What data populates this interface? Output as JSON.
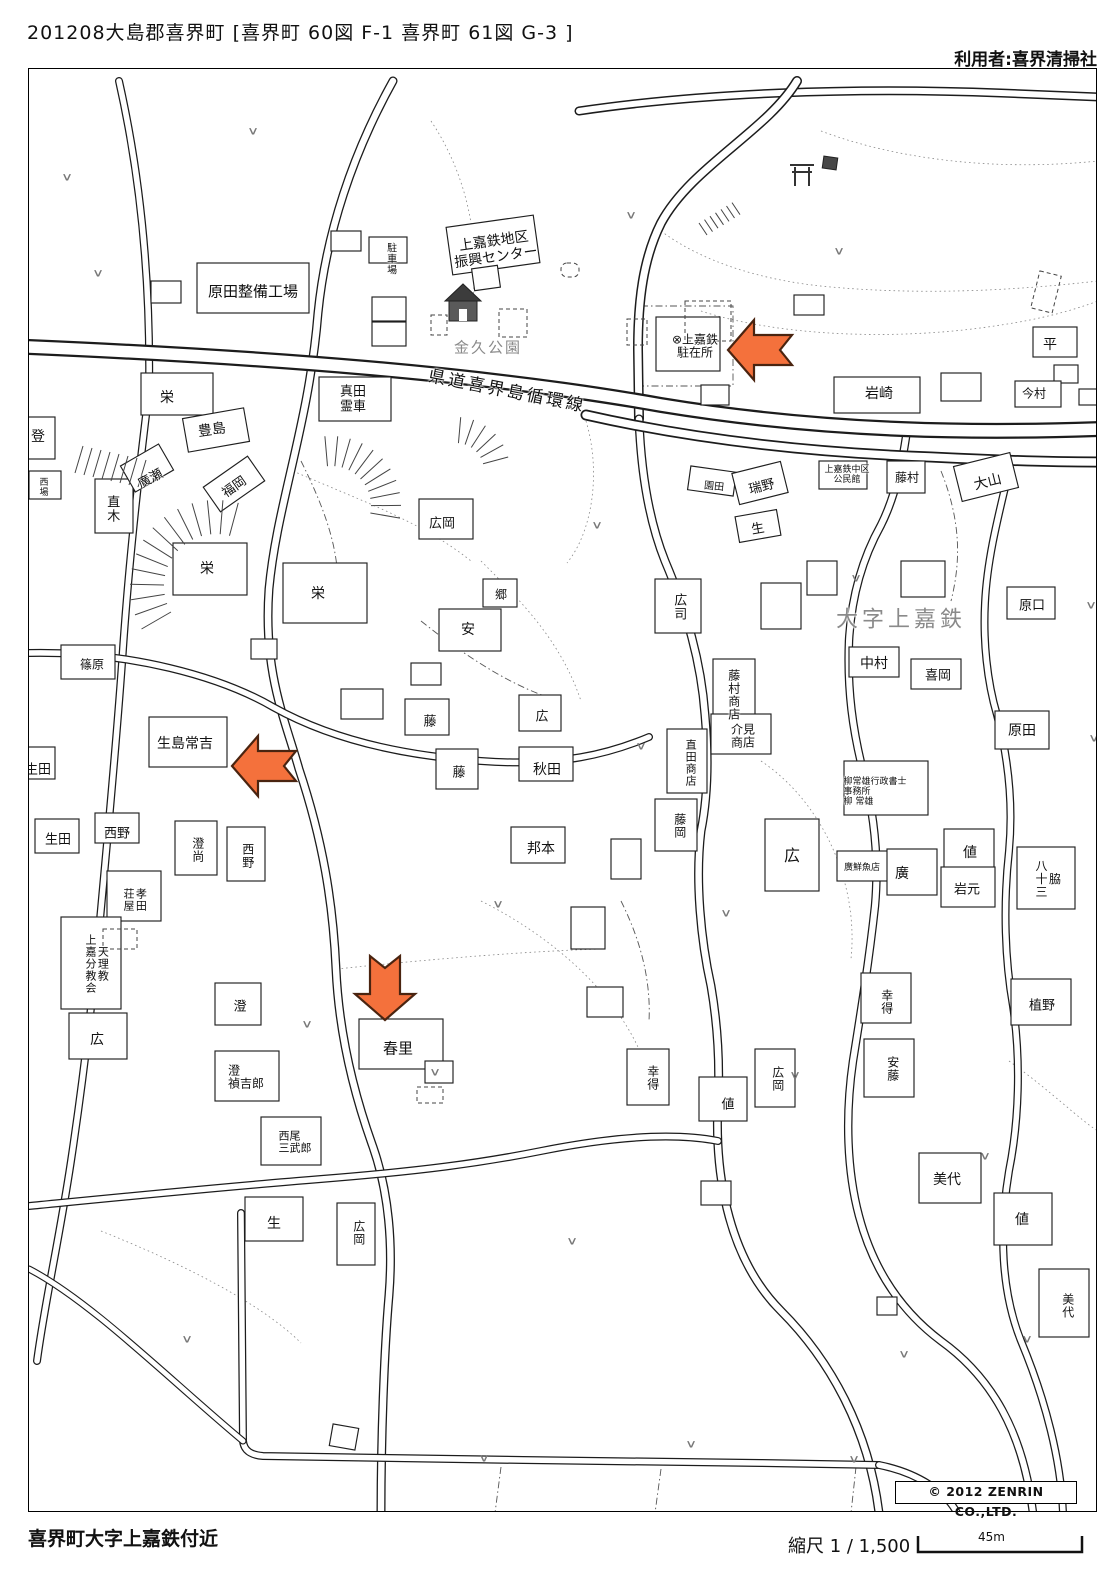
{
  "header": {
    "title": "201208大島郡喜界町 [喜界町 60図 F-1 喜界町 61図 G-3 ]",
    "user": "利用者:喜界清掃社"
  },
  "footer": {
    "area_name": "喜界町大字上嘉鉄付近",
    "scale_label": "縮尺 1 / 1,500",
    "scale_distance": "45m",
    "copyright": "© 2012 ZENRIN CO.,LTD."
  },
  "map": {
    "arrow_color": "#f4713c",
    "road_name": "県道喜界島循環線",
    "district_name": "大字上嘉鉄",
    "park_name": "金久公園",
    "labels": [
      {
        "t": "原田整備工場",
        "x": 252,
        "y": 291,
        "s": 15
      },
      {
        "t": "駐車場",
        "x": 389,
        "y": 258,
        "s": 10,
        "v": 1
      },
      {
        "t": "上嘉鉄地区\n振興センター",
        "x": 494,
        "y": 249,
        "s": 14,
        "r": -8
      },
      {
        "t": "金久公園",
        "x": 487,
        "y": 347,
        "s": 15,
        "c": "#8a8a8a",
        "w": 2
      },
      {
        "t": "県道喜界島循環線",
        "x": 506,
        "y": 391,
        "s": 17,
        "r": 11,
        "w": 3
      },
      {
        "t": "⊗上嘉鉄\n駐在所",
        "x": 694,
        "y": 346,
        "s": 12
      },
      {
        "t": "岩崎",
        "x": 878,
        "y": 394,
        "s": 14
      },
      {
        "t": "平",
        "x": 1049,
        "y": 345,
        "s": 14
      },
      {
        "t": "今村",
        "x": 1033,
        "y": 393,
        "s": 12
      },
      {
        "t": "栄",
        "x": 166,
        "y": 398,
        "s": 14
      },
      {
        "t": "豊島",
        "x": 211,
        "y": 430,
        "s": 14,
        "r": -8
      },
      {
        "t": "真田\n霊車",
        "x": 352,
        "y": 399,
        "s": 13
      },
      {
        "t": "福岡",
        "x": 234,
        "y": 487,
        "s": 13,
        "r": -35
      },
      {
        "t": "直木",
        "x": 110,
        "y": 508,
        "s": 13,
        "v": 1
      },
      {
        "t": "廣瀬",
        "x": 150,
        "y": 479,
        "s": 13,
        "r": -28
      },
      {
        "t": "登",
        "x": 37,
        "y": 437,
        "s": 14
      },
      {
        "t": "西\n場",
        "x": 43,
        "y": 487,
        "s": 9
      },
      {
        "t": "栄",
        "x": 206,
        "y": 569,
        "s": 14
      },
      {
        "t": "栄",
        "x": 317,
        "y": 594,
        "s": 14
      },
      {
        "t": "広岡",
        "x": 441,
        "y": 524,
        "s": 13
      },
      {
        "t": "郷",
        "x": 500,
        "y": 594,
        "s": 12
      },
      {
        "t": "安",
        "x": 467,
        "y": 630,
        "s": 14
      },
      {
        "t": "篠原",
        "x": 91,
        "y": 664,
        "s": 12
      },
      {
        "t": "園田",
        "x": 713,
        "y": 486,
        "s": 10,
        "r": 6
      },
      {
        "t": "瑞野",
        "x": 761,
        "y": 487,
        "s": 13,
        "r": -14
      },
      {
        "t": "生",
        "x": 757,
        "y": 529,
        "s": 13,
        "r": -10
      },
      {
        "t": "上嘉鉄中区\n公民館",
        "x": 846,
        "y": 474,
        "s": 9
      },
      {
        "t": "藤村",
        "x": 906,
        "y": 477,
        "s": 12
      },
      {
        "t": "大山",
        "x": 987,
        "y": 482,
        "s": 14,
        "r": -14
      },
      {
        "t": "大字上嘉鉄",
        "x": 900,
        "y": 620,
        "s": 22,
        "c": "#8a8a8a",
        "w": 4
      },
      {
        "t": "中村",
        "x": 873,
        "y": 664,
        "s": 14
      },
      {
        "t": "喜岡",
        "x": 937,
        "y": 676,
        "s": 13
      },
      {
        "t": "原口",
        "x": 1031,
        "y": 606,
        "s": 13
      },
      {
        "t": "原田",
        "x": 1021,
        "y": 731,
        "s": 14
      },
      {
        "t": "広司",
        "x": 677,
        "y": 606,
        "s": 13,
        "v": 1
      },
      {
        "t": "藤村商店",
        "x": 732,
        "y": 694,
        "s": 12,
        "v": 1
      },
      {
        "t": "介見\n商店",
        "x": 742,
        "y": 736,
        "s": 12
      },
      {
        "t": "直田商店",
        "x": 689,
        "y": 762,
        "s": 11,
        "v": 1
      },
      {
        "t": "藤岡",
        "x": 678,
        "y": 825,
        "s": 12,
        "v": 1
      },
      {
        "t": "広",
        "x": 791,
        "y": 855,
        "s": 16
      },
      {
        "t": "柳常雄行政書士\n事務所\n柳 常雄",
        "x": 874,
        "y": 791,
        "s": 9,
        "a": "left"
      },
      {
        "t": "値",
        "x": 969,
        "y": 853,
        "s": 14
      },
      {
        "t": "廣鮮魚店",
        "x": 861,
        "y": 867,
        "s": 9
      },
      {
        "t": "廣",
        "x": 901,
        "y": 874,
        "s": 14
      },
      {
        "t": "岩元",
        "x": 966,
        "y": 890,
        "s": 13
      },
      {
        "t": "脇\n八十三",
        "x": 1046,
        "y": 878,
        "s": 12,
        "v": 1
      },
      {
        "t": "生島常吉",
        "x": 184,
        "y": 744,
        "s": 14
      },
      {
        "t": "生田",
        "x": 37,
        "y": 770,
        "s": 13
      },
      {
        "t": "生田",
        "x": 57,
        "y": 840,
        "s": 13
      },
      {
        "t": "西野",
        "x": 116,
        "y": 834,
        "s": 13
      },
      {
        "t": "澄尚",
        "x": 196,
        "y": 849,
        "s": 12,
        "v": 1
      },
      {
        "t": "西野",
        "x": 246,
        "y": 855,
        "s": 12,
        "v": 1
      },
      {
        "t": "孝田\n荘屋",
        "x": 133,
        "y": 899,
        "s": 11,
        "v": 1
      },
      {
        "t": "天理教\n上嘉分教会",
        "x": 95,
        "y": 963,
        "s": 11,
        "v": 1
      },
      {
        "t": "藤",
        "x": 429,
        "y": 722,
        "s": 13
      },
      {
        "t": "藤",
        "x": 458,
        "y": 773,
        "s": 13
      },
      {
        "t": "広",
        "x": 541,
        "y": 717,
        "s": 13
      },
      {
        "t": "秋田",
        "x": 546,
        "y": 770,
        "s": 14
      },
      {
        "t": "邦本",
        "x": 540,
        "y": 849,
        "s": 14
      },
      {
        "t": "広",
        "x": 96,
        "y": 1040,
        "s": 14
      },
      {
        "t": "澄",
        "x": 239,
        "y": 1007,
        "s": 13
      },
      {
        "t": "澄\n禎吉郎",
        "x": 245,
        "y": 1077,
        "s": 12,
        "a": "left"
      },
      {
        "t": "西尾\n三武郎",
        "x": 294,
        "y": 1142,
        "s": 11,
        "a": "left"
      },
      {
        "t": "春里",
        "x": 397,
        "y": 1048,
        "s": 15
      },
      {
        "t": "生",
        "x": 273,
        "y": 1224,
        "s": 14
      },
      {
        "t": "広岡",
        "x": 357,
        "y": 1232,
        "s": 12,
        "v": 1
      },
      {
        "t": "幸得",
        "x": 885,
        "y": 1001,
        "s": 12,
        "v": 1
      },
      {
        "t": "植野",
        "x": 1041,
        "y": 1006,
        "s": 13
      },
      {
        "t": "幸得",
        "x": 651,
        "y": 1077,
        "s": 12,
        "v": 1
      },
      {
        "t": "値",
        "x": 727,
        "y": 1105,
        "s": 13
      },
      {
        "t": "広岡",
        "x": 776,
        "y": 1078,
        "s": 12,
        "v": 1
      },
      {
        "t": "安藤",
        "x": 891,
        "y": 1068,
        "s": 12,
        "v": 1
      },
      {
        "t": "美代",
        "x": 946,
        "y": 1180,
        "s": 14
      },
      {
        "t": "値",
        "x": 1021,
        "y": 1220,
        "s": 14
      },
      {
        "t": "美代",
        "x": 1066,
        "y": 1305,
        "s": 12,
        "v": 1
      }
    ],
    "vegetation_mark": "∨",
    "vegetation_points": [
      [
        66,
        176
      ],
      [
        252,
        130
      ],
      [
        630,
        214
      ],
      [
        838,
        250
      ],
      [
        97,
        272
      ],
      [
        596,
        524
      ],
      [
        855,
        577
      ],
      [
        1090,
        604
      ],
      [
        640,
        745
      ],
      [
        497,
        903
      ],
      [
        725,
        912
      ],
      [
        306,
        1023
      ],
      [
        434,
        1071
      ],
      [
        794,
        1074
      ],
      [
        984,
        1155
      ],
      [
        1093,
        737
      ],
      [
        186,
        1338
      ],
      [
        571,
        1240
      ],
      [
        483,
        1457
      ],
      [
        690,
        1443
      ],
      [
        853,
        1458
      ],
      [
        903,
        1353
      ],
      [
        1026,
        1338
      ]
    ],
    "arrows": [
      {
        "x": 727,
        "y": 347,
        "d": "left"
      },
      {
        "x": 231,
        "y": 763,
        "d": "left"
      },
      {
        "x": 382,
        "y": 1019,
        "d": "down"
      }
    ]
  }
}
